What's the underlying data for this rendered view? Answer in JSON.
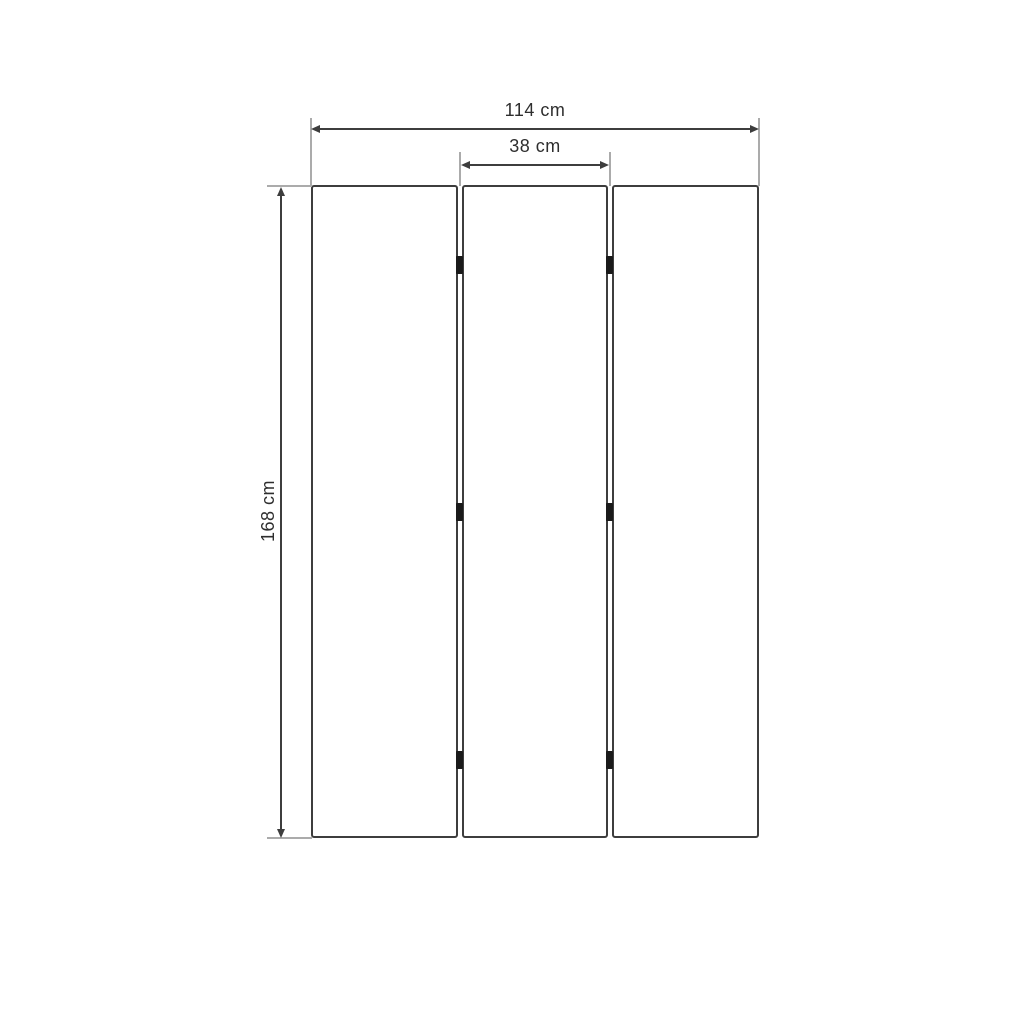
{
  "labels": {
    "total_width": "114 cm",
    "panel_width": "38 cm",
    "height": "168 cm"
  },
  "structure": {
    "panel_count": 3,
    "hinge_rows": 3
  },
  "colors": {
    "background": "#ffffff",
    "outline": "#3d3d3d",
    "dimension": "#3d3d3d",
    "extension": "#ababab",
    "hinge": "#1a1a1a",
    "text": "#2e2e2e"
  }
}
